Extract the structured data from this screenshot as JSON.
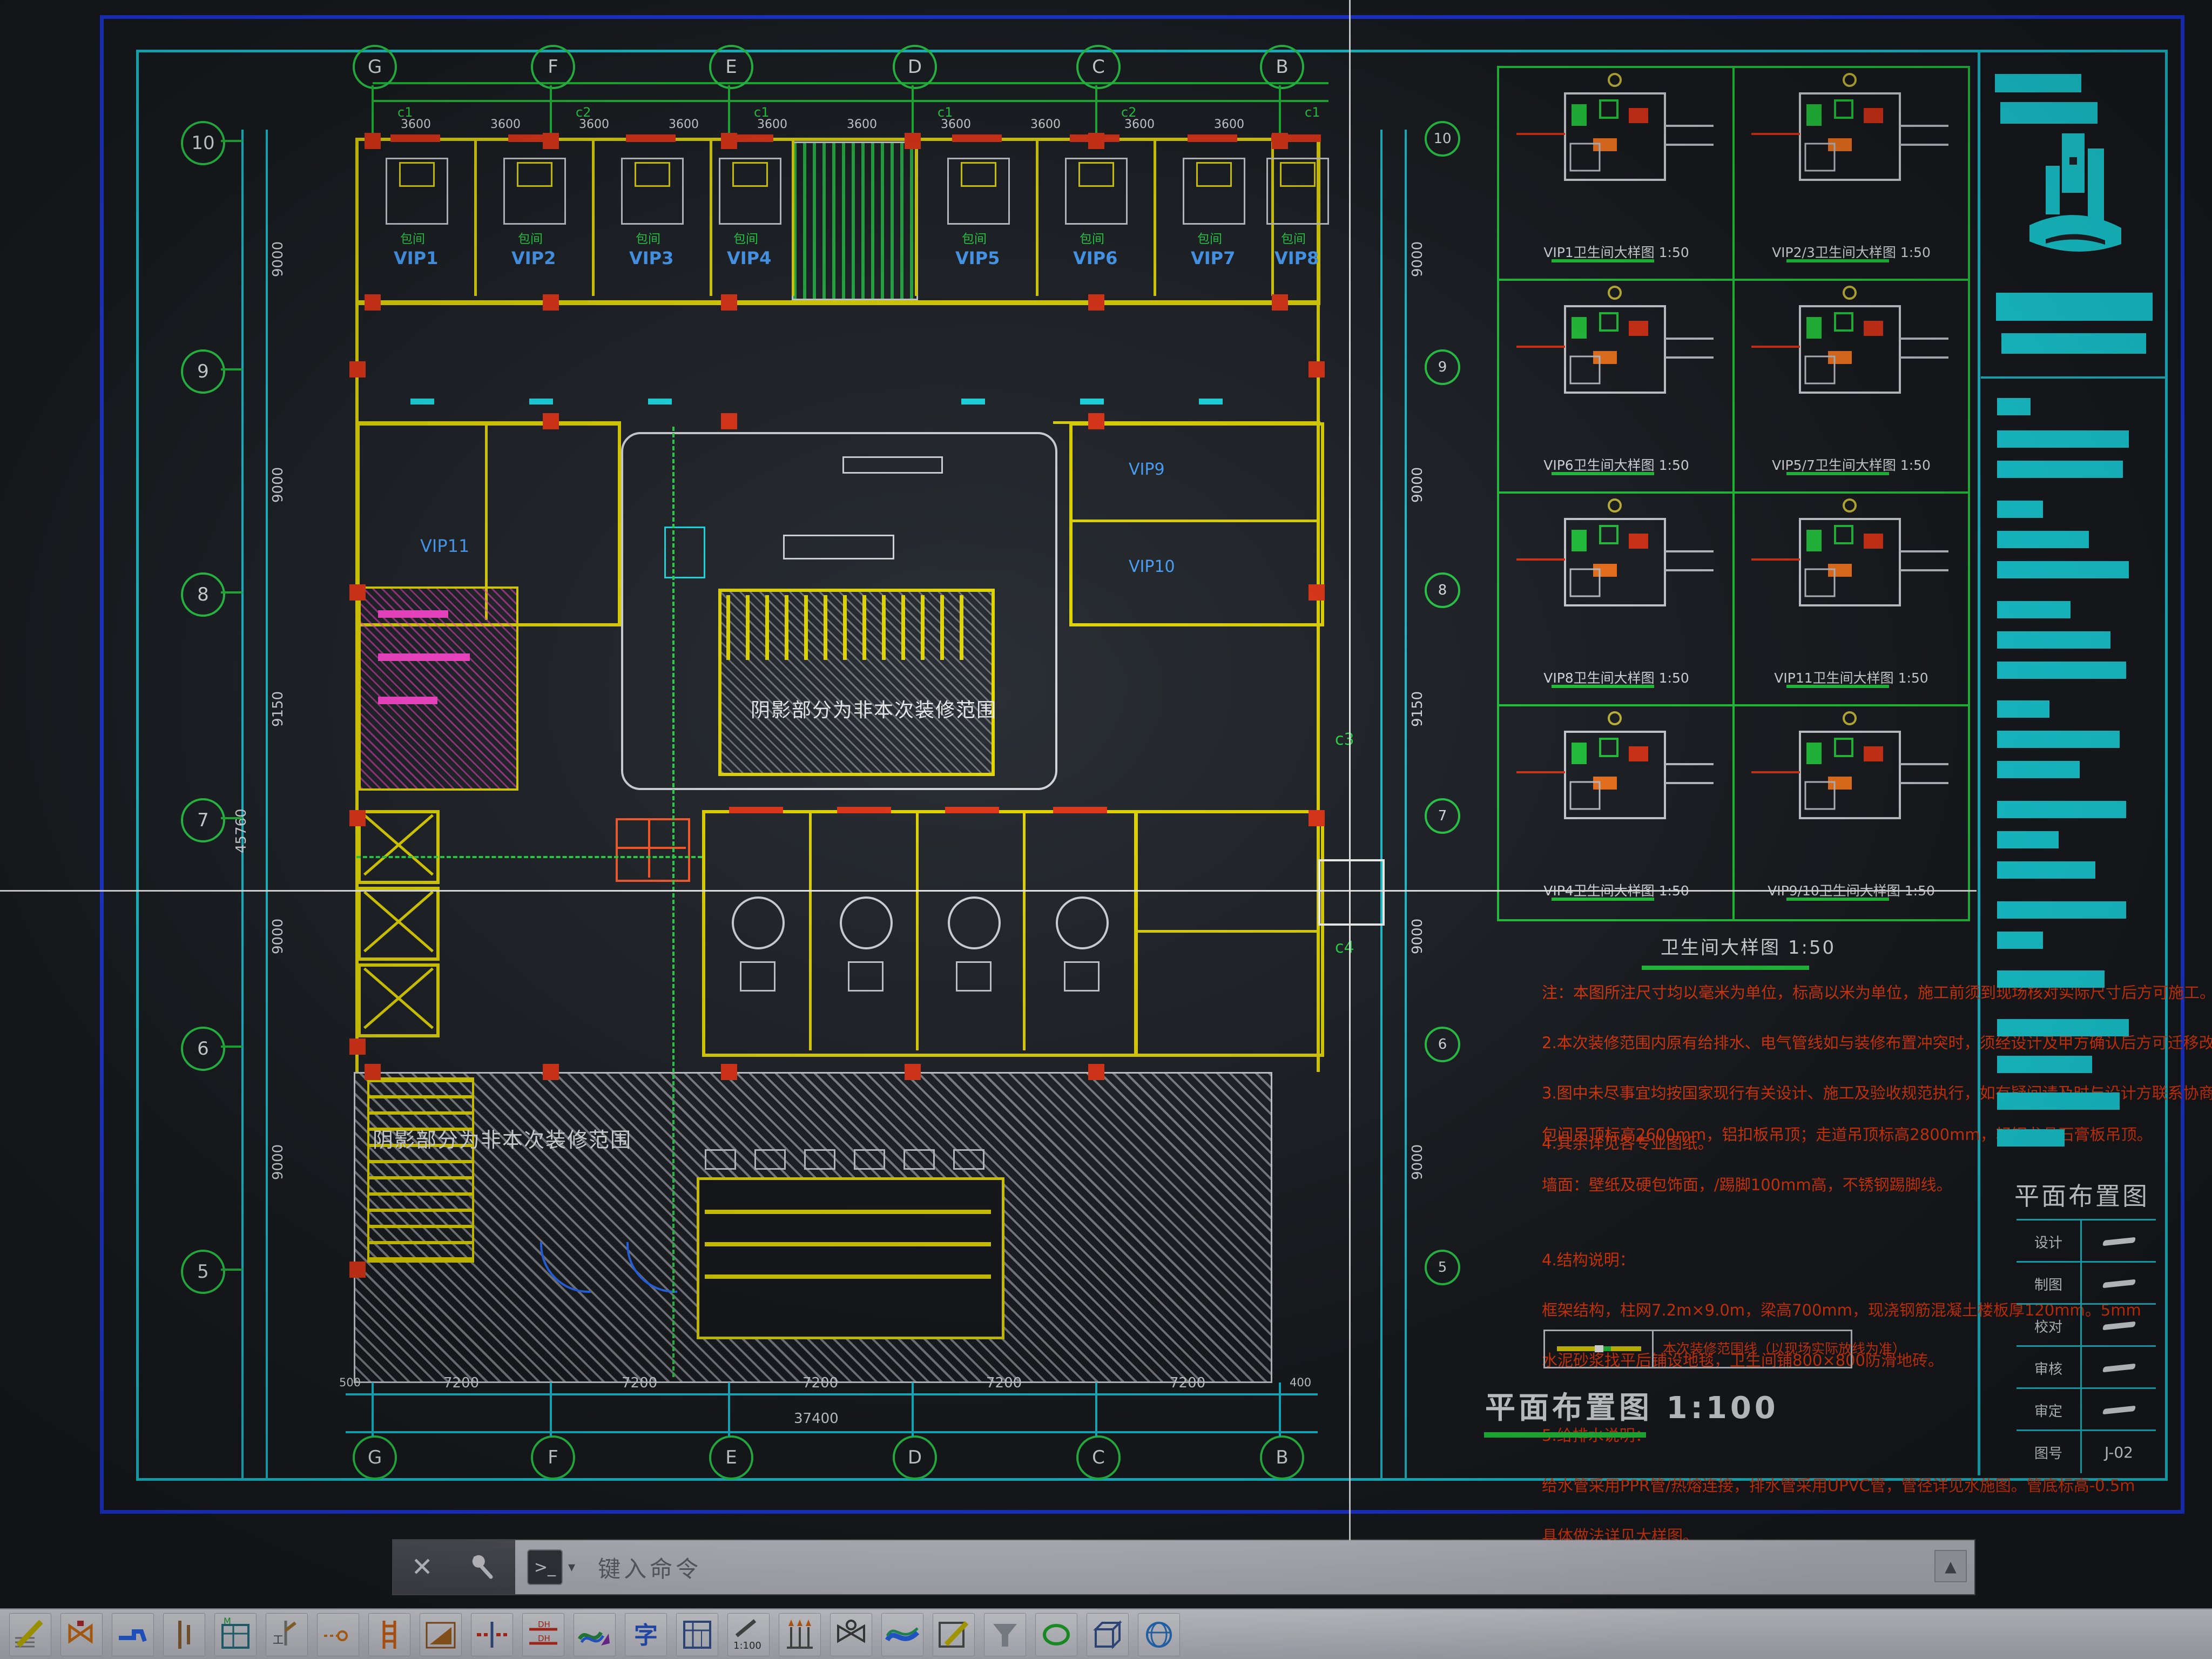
{
  "app": {
    "command_bar": {
      "close_label": "✕",
      "prompt_glyph": ">_",
      "dropdown_glyph": "▾",
      "placeholder": "键入命令",
      "scroll_up_glyph": "▲"
    },
    "toolbar_icons": [
      {
        "name": "hatch-pencil-icon"
      },
      {
        "name": "valve-icon"
      },
      {
        "name": "faucet-icon"
      },
      {
        "name": "riser-pipe-icon"
      },
      {
        "name": "material-table-icon",
        "label": "M"
      },
      {
        "name": "pipe-tee-icon",
        "label": "工"
      },
      {
        "name": "small-valve-icon"
      },
      {
        "name": "pipe-ladder-icon"
      },
      {
        "name": "ramp-icon"
      },
      {
        "name": "pipe-break-icon",
        "label": "H"
      },
      {
        "name": "pipe-dim-icon",
        "label": "DH"
      },
      {
        "name": "paint-brush-icon"
      },
      {
        "name": "text-style-icon",
        "label": "字"
      },
      {
        "name": "schedule-form-icon"
      },
      {
        "name": "scale-icon",
        "label": "1:100"
      },
      {
        "name": "pipe-array-icon"
      },
      {
        "name": "valve-symbol-icon"
      },
      {
        "name": "wave-pipe-icon"
      },
      {
        "name": "edit-pencil-icon"
      },
      {
        "name": "funnel-icon"
      },
      {
        "name": "ellipse-icon"
      },
      {
        "name": "box-3d-icon"
      },
      {
        "name": "sphere-icon"
      }
    ]
  },
  "sheet": {
    "plan": {
      "title": "平面布置图",
      "scale": "1:100",
      "col_bubbles": [
        "G",
        "F",
        "E",
        "D",
        "C",
        "B"
      ],
      "row_bubbles": [
        "10",
        "9",
        "8",
        "7",
        "6",
        "5"
      ],
      "bay_dims": [
        "7200",
        "7200",
        "7200",
        "7200",
        "7200"
      ],
      "sub_dims": [
        "3600",
        "3600",
        "3600",
        "3600",
        "3600",
        "3600",
        "3600",
        "3600",
        "3600",
        "3600"
      ],
      "axis_tags": [
        "c1",
        "c2",
        "c1",
        "c1",
        "c2",
        "c1"
      ],
      "side_tags": [
        "c3",
        "c4"
      ],
      "edge_dim_left": "500",
      "edge_dim_right": "400",
      "total_width": "37400",
      "row_dims": [
        "9000",
        "9000",
        "9150",
        "9000",
        "9000"
      ],
      "total_height": "45760",
      "rooms_top": [
        "VIP1",
        "VIP2",
        "VIP3",
        "VIP4",
        "VIP5",
        "VIP6",
        "VIP7",
        "VIP8"
      ],
      "room_tag": "包间",
      "rooms_mid": [
        "VIP9",
        "VIP10",
        "VIP11"
      ],
      "hatch_note": "阴影部分为非本次装修范围"
    },
    "details": {
      "title": "卫生间大样图",
      "scale": "1:50",
      "cells": [
        {
          "label": "VIP1卫生间大样图 1:50"
        },
        {
          "label": "VIP2/3卫生间大样图 1:50"
        },
        {
          "label": "VIP6卫生间大样图 1:50"
        },
        {
          "label": "VIP5/7卫生间大样图 1:50"
        },
        {
          "label": "VIP8卫生间大样图 1:50"
        },
        {
          "label": "VIP11卫生间大样图 1:50"
        },
        {
          "label": "VIP4卫生间大样图 1:50"
        },
        {
          "label": "VIP9/10卫生间大样图 1:50"
        }
      ]
    },
    "notes1": [
      "注：本图所注尺寸均以毫米为单位，标高以米为单位，施工前须到现场核对实际尺寸后方可施工。",
      "2.本次装修范围内原有给排水、电气管线如与装修布置冲突时，须经设计及甲方确认后方可迁移改造，隐蔽工程须经验收合格后方可封闭。",
      "3.图中未尽事宜均按国家现行有关设计、施工及验收规范执行，如有疑问请及时与设计方联系协商解决，不得擅自变更。",
      "4.其余详见各专业图纸。"
    ],
    "notes2": [
      "包间吊顶标高2600mm，铝扣板吊顶；走道吊顶标高2800mm，轻钢龙骨石膏板吊顶。",
      "墙面：壁纸及硬包饰面，/踢脚100mm高，不锈钢踢脚线。",
      "",
      "4.结构说明：",
      "框架结构，柱网7.2m×9.0m，梁高700mm，现浇钢筋混凝土楼板厚120mm。5mm",
      "水泥砂浆找平后铺设地毯，卫生间铺800×800防滑地砖。",
      "",
      "5.给排水说明：",
      "给水管采用PPR管/热熔连接，排水管采用UPVC管，管径详见水施图。管底标高-0.5m",
      "具体做法详见大样图。"
    ],
    "legend": {
      "label": "本次装修范围线（以现场实际放线为准）"
    },
    "title_block": {
      "title": "平面布置图",
      "rows": [
        {
          "label": "设计",
          "value": ""
        },
        {
          "label": "制图",
          "value": ""
        },
        {
          "label": "校对",
          "value": ""
        },
        {
          "label": "审核",
          "value": ""
        },
        {
          "label": "审定",
          "value": ""
        },
        {
          "label": "图号",
          "value": "J-02"
        }
      ]
    }
  }
}
